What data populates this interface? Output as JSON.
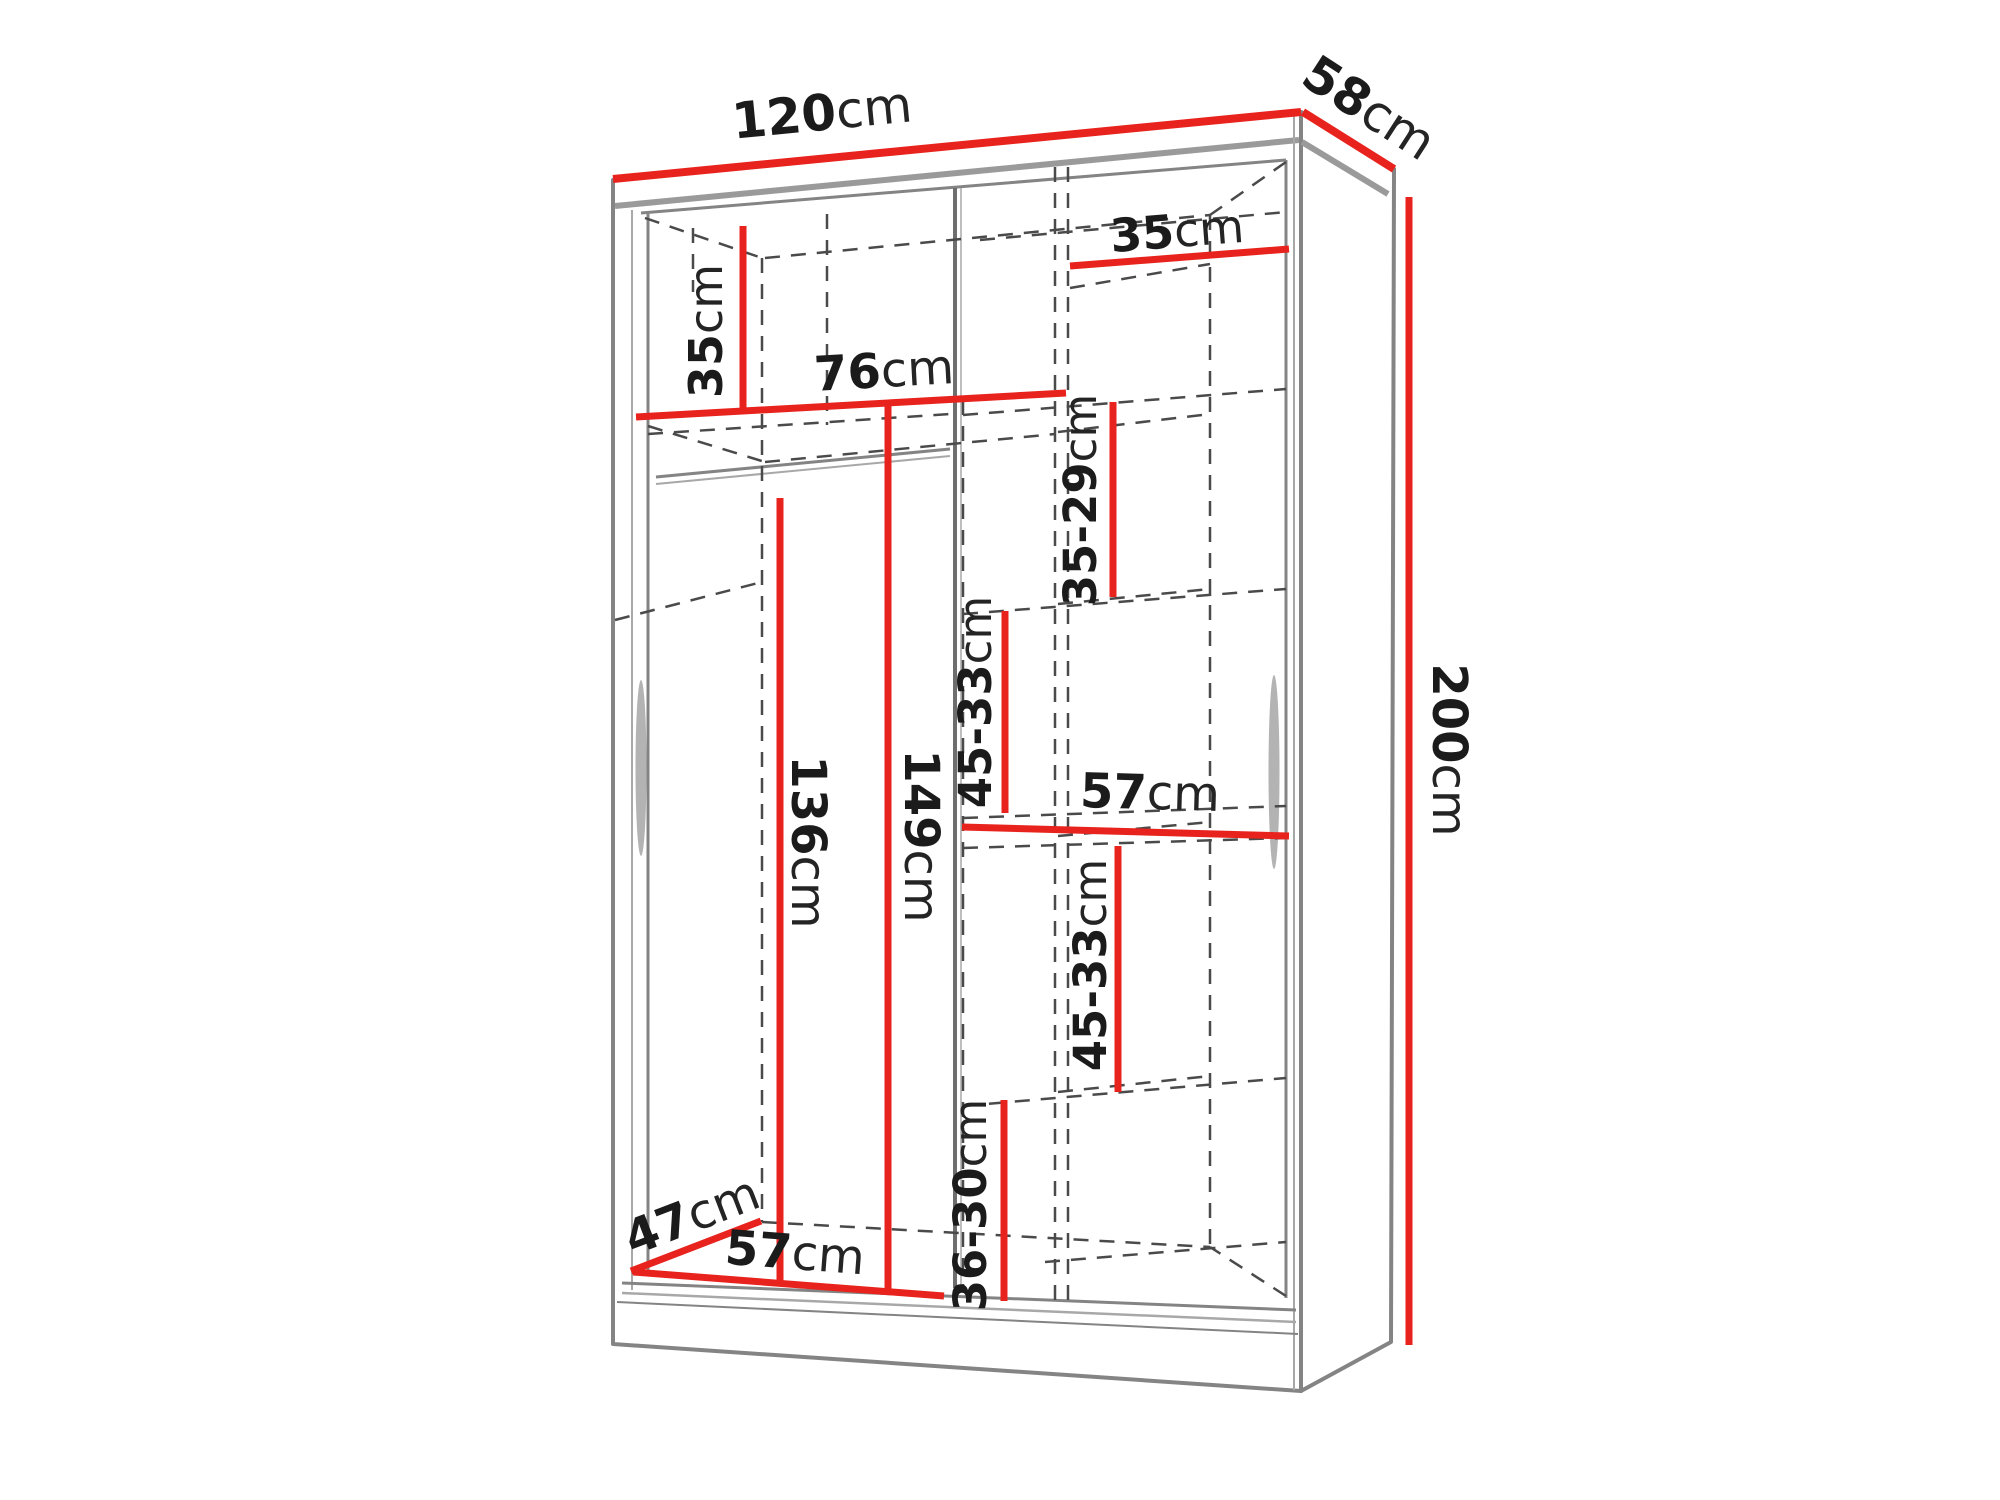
{
  "colors": {
    "accent": "#e8231d",
    "cabinet_outline": "#848484",
    "hidden_lines": "#4a4a4a",
    "label_text": "#1b1b1b",
    "background": "#ffffff"
  },
  "labels": [
    {
      "name": "width-top",
      "value": "120",
      "unit": "cm"
    },
    {
      "name": "depth-top",
      "value": "58",
      "unit": "cm"
    },
    {
      "name": "height-right",
      "value": "200",
      "unit": "cm"
    },
    {
      "name": "top-left-height",
      "value": "35",
      "unit": "cm"
    },
    {
      "name": "top-right-width",
      "value": "35",
      "unit": "cm"
    },
    {
      "name": "left-section-width",
      "value": "76",
      "unit": "cm"
    },
    {
      "name": "shelf-gap-1",
      "value": "35-29",
      "unit": "cm"
    },
    {
      "name": "shelf-gap-2",
      "value": "45-33",
      "unit": "cm"
    },
    {
      "name": "middle-shelf-width",
      "value": "57",
      "unit": "cm"
    },
    {
      "name": "shelf-gap-3",
      "value": "45-33",
      "unit": "cm"
    },
    {
      "name": "shelf-gap-4",
      "value": "36-30",
      "unit": "cm"
    },
    {
      "name": "hang-height-left",
      "value": "136",
      "unit": "cm"
    },
    {
      "name": "hang-height-right",
      "value": "149",
      "unit": "cm"
    },
    {
      "name": "bottom-depth",
      "value": "47",
      "unit": "cm"
    },
    {
      "name": "bottom-width",
      "value": "57",
      "unit": "cm"
    }
  ]
}
